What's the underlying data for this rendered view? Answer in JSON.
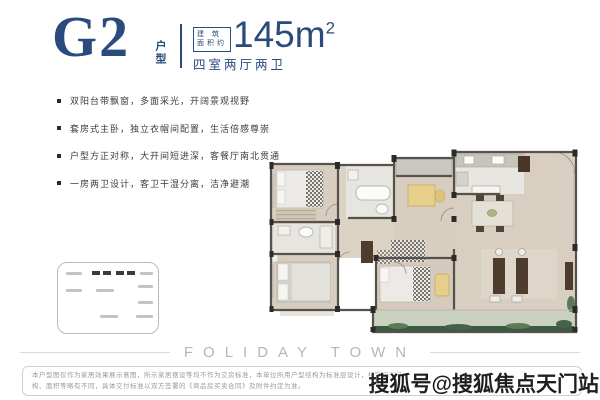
{
  "header": {
    "unit_code": "G2",
    "unit_label": "户型",
    "area_badge_line1": "建 筑",
    "area_badge_line2": "面积约",
    "area_value": "145m",
    "area_sup": "2",
    "layout_desc": "四室两厅两卫"
  },
  "features": [
    "双阳台带飘窗，多面采光，开阔景观视野",
    "套房式主卧，独立衣帽间配置，生活倍感尊崇",
    "户型方正对称，大开间短进深，客餐厅南北贯通",
    "一房两卫设计，客卫干湿分离，洁净避潮"
  ],
  "footer": {
    "brand": "FOLIDAY TOWN"
  },
  "disclaimer": {
    "line1": "本户型图仅作为家居效果展示意图，所示家居摆设等均不作为交房标准，本单位所用户型结构为标准层设计，相同户型结",
    "line2": "构、面积等略有不同，具体交付标准以双方签署的《商品房买卖合同》及附件约定为准。"
  },
  "watermark": "搜狐号@搜狐焦点天门站",
  "colors": {
    "accent_navy": "#2a4b7c",
    "wall_gray": "#54524b",
    "floor_beige": "#d8cec0",
    "bath_floor": "#e7e5df",
    "balcony_floor": "#cbd1bf",
    "plant_green": "#3c5a42",
    "desk_yellow": "#e6cf8a",
    "furniture_brown": "#4e3d2c",
    "brand_gray": "#b3b7b9",
    "disclaimer_gray": "#9a9a9a"
  }
}
